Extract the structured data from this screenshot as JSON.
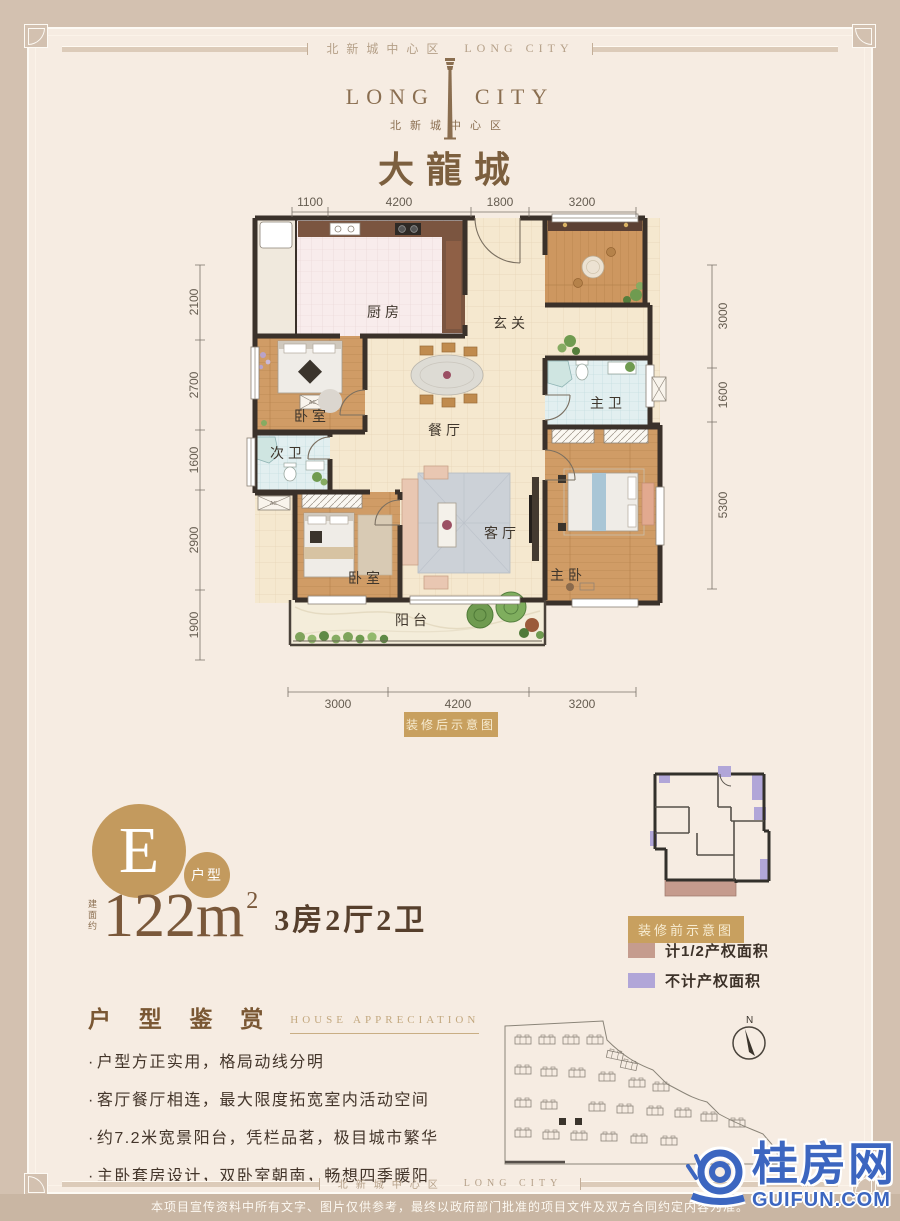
{
  "page": {
    "outer_bg": "#d3c1b0",
    "panel_bg": "#f6ece2"
  },
  "brand": {
    "top_band_cn": "北新城中心区",
    "top_band_en": "LONG CITY",
    "logo_en_left": "LONG",
    "logo_en_right": "CITY",
    "logo_sub_cn": "北新城中心区",
    "logo_name_cn": "大龍城",
    "brand_brown": "#8a6e50"
  },
  "floorplan": {
    "badge_after": "装修后示意图",
    "dims_top": [
      "1100",
      "4200",
      "1800",
      "3200"
    ],
    "dims_left": [
      "2100",
      "2700",
      "1600",
      "2900",
      "1900"
    ],
    "dims_right": [
      "3000",
      "1600",
      "5300"
    ],
    "dims_bottom": [
      "3000",
      "4200",
      "3200"
    ],
    "rooms": {
      "kitchen": "厨房",
      "foyer": "玄关",
      "bedroom1": "卧室",
      "dining": "餐厅",
      "master_bath": "主卫",
      "second_bath": "次卫",
      "living": "客厅",
      "bedroom2": "卧室",
      "master_bedroom": "主卧",
      "balcony": "阳台"
    },
    "ac_label": "AC"
  },
  "unit": {
    "letter": "E",
    "type_label": "户型",
    "area_prefix": "建面约",
    "area_value": "122m",
    "area_sup": "2",
    "rooms_label": "3房2厅2卫",
    "accent_gold": "#c39a5e"
  },
  "before_plan": {
    "badge": "装修前示意图",
    "legend": [
      {
        "label": "计1/2产权面积",
        "color": "#c59c8e"
      },
      {
        "label": "不计产权面积",
        "color": "#b1a6d8"
      }
    ]
  },
  "appreciation": {
    "title_cn": "户 型 鉴 赏",
    "title_en": "HOUSE APPRECIATION",
    "bullet_marker": "·",
    "bullets": [
      "户型方正实用，格局动线分明",
      "客厅餐厅相连，最大限度拓宽室内活动空间",
      "约7.2米宽景阳台，凭栏品茗，极目城市繁华",
      "主卧套房设计，双卧室朝南，畅想四季暖阳"
    ]
  },
  "siteplan": {
    "compass": "N"
  },
  "watermark": {
    "cn": "桂房网",
    "en": "GUIFUN.COM",
    "blue": "#3c66c0"
  },
  "footer": {
    "band_cn": "北新城中心区",
    "band_en": "LONG CITY",
    "disclaimer": "本项目宣传资料中所有文字、图片仅供参考，最终以政府部门批准的项目文件及双方合同约定内容为准。"
  }
}
